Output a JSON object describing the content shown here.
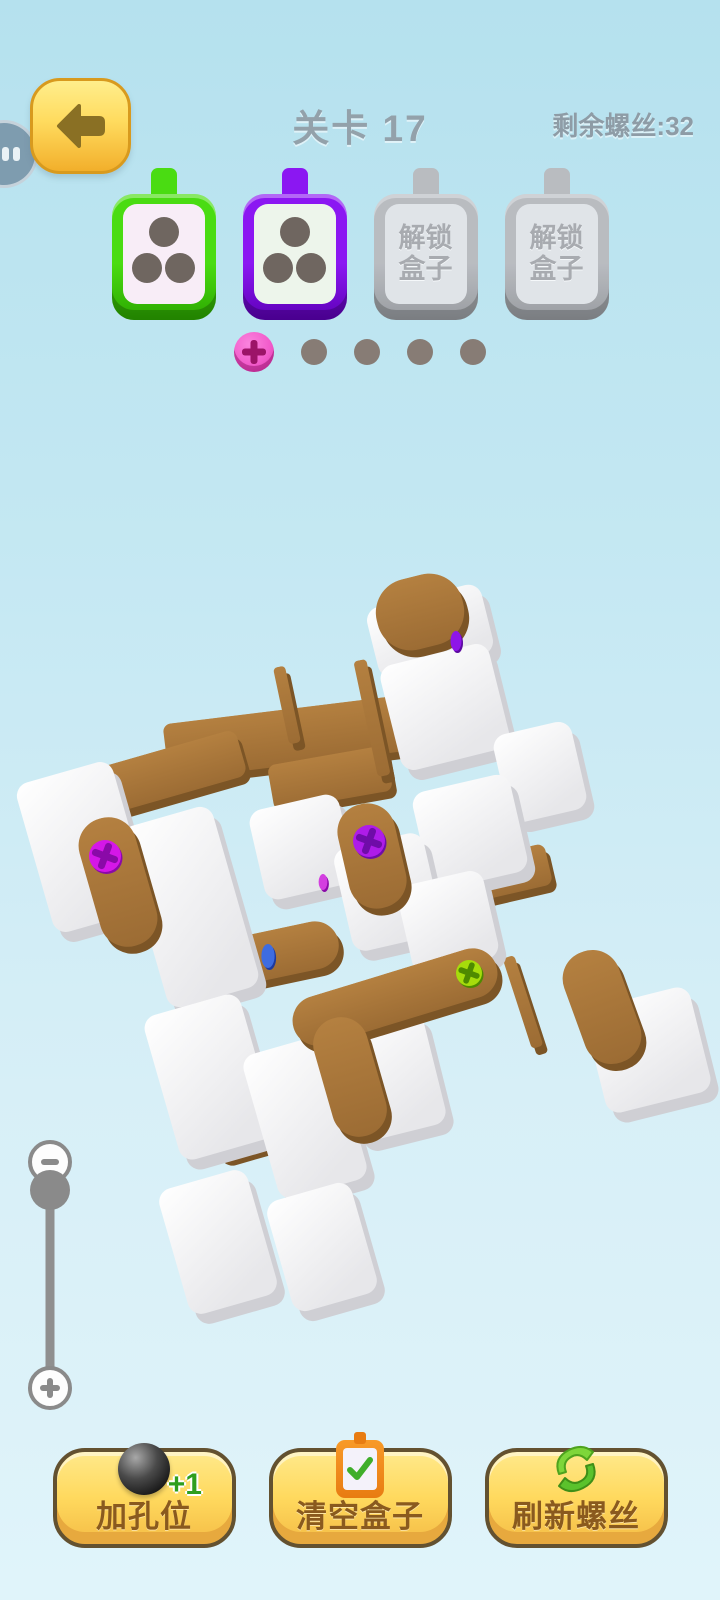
{
  "header": {
    "title": "关卡 17",
    "remaining_label": "剩余螺丝:32",
    "back_icon": "arrow-left-icon",
    "plug_icon": "floating-plug-icon"
  },
  "boxes": [
    {
      "type": "active",
      "color": "#4ADC12",
      "color_dark": "#2CA800",
      "inner": "#F8EDF7",
      "holes": 3
    },
    {
      "type": "active",
      "color": "#8B17F2",
      "color_dark": "#5E00B8",
      "inner": "#EDF5EB",
      "holes": 3
    },
    {
      "type": "locked",
      "color": "#B9B9BD",
      "color_dark": "#97979B",
      "inner": "#E4E4E8",
      "label": "解锁\n盒子"
    },
    {
      "type": "locked",
      "color": "#B9B9BD",
      "color_dark": "#97979B",
      "inner": "#E4E4E8",
      "label": "解锁\n盒子"
    }
  ],
  "slots": {
    "add_icon": "plus-icon",
    "empty_count": 4
  },
  "zoom_slider": {
    "minus_icon": "minus-icon",
    "plus_icon": "plus-icon"
  },
  "buttons": [
    {
      "label": "加孔位",
      "icon": "black-ball-icon",
      "badge": "+1"
    },
    {
      "label": "清空盒子",
      "icon": "clipboard-check-icon"
    },
    {
      "label": "刷新螺丝",
      "icon": "refresh-leaves-icon"
    }
  ],
  "puzzle": {
    "colors": {
      "plank_top": "#AC783C",
      "plank_side": "#7C5526",
      "block_face1": "#FFFFFF",
      "block_face2": "#E9E9EC",
      "block_side": "#CFCFD4"
    },
    "planks": [
      {
        "x": 290,
        "y": 737,
        "w": 250,
        "h": 56,
        "rot": -7,
        "r": 8,
        "front": false
      },
      {
        "x": 330,
        "y": 778,
        "w": 120,
        "h": 46,
        "rot": -10,
        "r": 8,
        "front": false
      },
      {
        "x": 150,
        "y": 778,
        "w": 190,
        "h": 48,
        "rot": -16,
        "r": 10,
        "front": false
      },
      {
        "x": 287,
        "y": 705,
        "w": 12,
        "h": 78,
        "rot": -12,
        "r": 4,
        "front": false
      },
      {
        "x": 372,
        "y": 718,
        "w": 13,
        "h": 118,
        "rot": -12,
        "r": 4,
        "front": false
      },
      {
        "x": 260,
        "y": 957,
        "w": 160,
        "h": 48,
        "rot": -12,
        "r": 24,
        "front": false
      },
      {
        "x": 215,
        "y": 1042,
        "w": 58,
        "h": 232,
        "rot": -16,
        "r": 12,
        "front": false
      },
      {
        "x": 490,
        "y": 877,
        "w": 120,
        "h": 42,
        "rot": -13,
        "r": 8,
        "front": false
      },
      {
        "x": 523,
        "y": 1002,
        "w": 12,
        "h": 95,
        "rot": -18,
        "r": 4,
        "front": false
      },
      {
        "x": 420,
        "y": 612,
        "w": 88,
        "h": 72,
        "rot": -14,
        "r": 34,
        "front": true
      },
      {
        "x": 118,
        "y": 882,
        "w": 58,
        "h": 132,
        "rot": -16,
        "r": 28,
        "front": true
      },
      {
        "x": 372,
        "y": 856,
        "w": 58,
        "h": 106,
        "rot": -13,
        "r": 28,
        "front": true
      },
      {
        "x": 395,
        "y": 997,
        "w": 212,
        "h": 50,
        "rot": -17,
        "r": 25,
        "front": true
      },
      {
        "x": 350,
        "y": 1077,
        "w": 55,
        "h": 122,
        "rot": -16,
        "r": 27,
        "front": true
      },
      {
        "x": 602,
        "y": 1007,
        "w": 58,
        "h": 117,
        "rot": -20,
        "r": 28,
        "front": true
      }
    ],
    "blocks": [
      {
        "x": 430,
        "y": 631,
        "w": 118,
        "h": 72,
        "rot": -14
      },
      {
        "x": 445,
        "y": 707,
        "w": 112,
        "h": 108,
        "rot": -14
      },
      {
        "x": 540,
        "y": 772,
        "w": 80,
        "h": 90,
        "rot": -13
      },
      {
        "x": 83,
        "y": 847,
        "w": 100,
        "h": 155,
        "rot": -16
      },
      {
        "x": 190,
        "y": 907,
        "w": 95,
        "h": 188,
        "rot": -16
      },
      {
        "x": 302,
        "y": 847,
        "w": 92,
        "h": 92,
        "rot": -13
      },
      {
        "x": 470,
        "y": 832,
        "w": 100,
        "h": 100,
        "rot": -13
      },
      {
        "x": 388,
        "y": 892,
        "w": 92,
        "h": 105,
        "rot": -13
      },
      {
        "x": 448,
        "y": 922,
        "w": 88,
        "h": 90,
        "rot": -13
      },
      {
        "x": 210,
        "y": 1077,
        "w": 100,
        "h": 150,
        "rot": -16
      },
      {
        "x": 305,
        "y": 1117,
        "w": 92,
        "h": 150,
        "rot": -16
      },
      {
        "x": 390,
        "y": 1077,
        "w": 92,
        "h": 115,
        "rot": -14
      },
      {
        "x": 218,
        "y": 1242,
        "w": 92,
        "h": 130,
        "rot": -16
      },
      {
        "x": 322,
        "y": 1247,
        "w": 88,
        "h": 115,
        "rot": -16
      },
      {
        "x": 648,
        "y": 1050,
        "w": 108,
        "h": 108,
        "rot": -14
      }
    ],
    "screws": [
      {
        "x": 456,
        "y": 641,
        "r": 10,
        "color": "#8E16E8",
        "dark": "#5C0AA0",
        "edge": true
      },
      {
        "x": 105,
        "y": 856,
        "r": 16,
        "color": "#D517E8",
        "dark": "#8A0AA8",
        "edge": false
      },
      {
        "x": 369,
        "y": 841,
        "r": 16,
        "color": "#AE1CE8",
        "dark": "#6F0CA8",
        "edge": false
      },
      {
        "x": 323,
        "y": 882,
        "r": 8,
        "color": "#D33FE0",
        "dark": "#8A0AA8",
        "edge": true
      },
      {
        "x": 268,
        "y": 956,
        "r": 12,
        "color": "#3E6CE0",
        "dark": "#1E3A9E",
        "edge": true
      },
      {
        "x": 469,
        "y": 973,
        "r": 13,
        "color": "#A6DC0C",
        "dark": "#4E8A00",
        "edge": false
      }
    ]
  }
}
